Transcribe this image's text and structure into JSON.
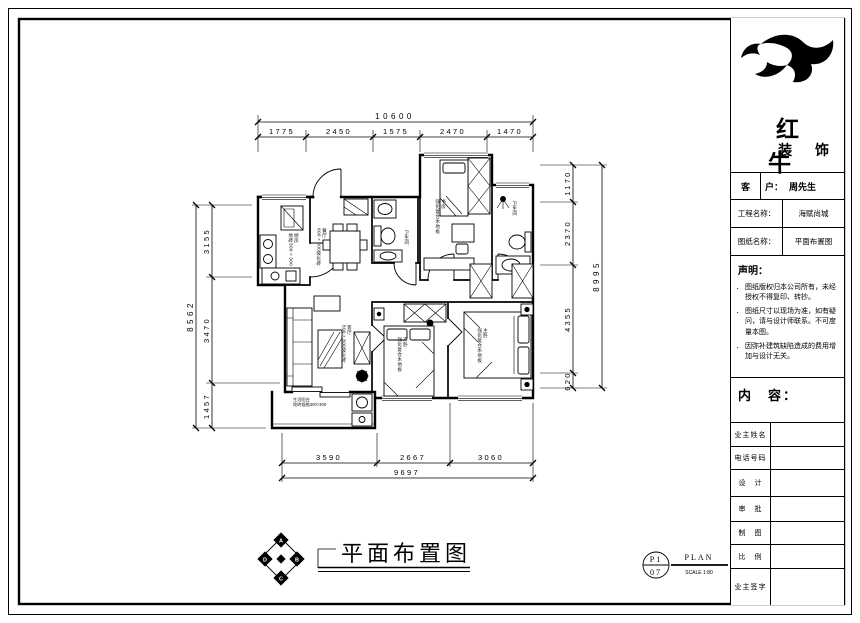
{
  "titleblock": {
    "brand_line1": "红 牛",
    "brand_line2": "装 饰",
    "client_label": "客",
    "client_field": "户：",
    "client_value": "周先生",
    "project_label": "工程名称：",
    "project_value": "海赋尚城",
    "sheet_label": "图纸名称：",
    "sheet_value": "平面布置图",
    "statement_title": "声明：",
    "statement_items": [
      "图纸版权归本公司所有，未经授权不得复印、转抄。",
      "图纸尺寸以现场为准，如有疑问，请与设计师联系。不可度量本图。",
      "因弥补建筑缺陷造成的费用增加与设计无关。"
    ],
    "content_label": "内　容：",
    "footer_rows": [
      {
        "label": "业主姓名",
        "value": ""
      },
      {
        "label": "电话号码",
        "value": ""
      },
      {
        "label": "设　计",
        "value": ""
      },
      {
        "label": "审　批",
        "value": ""
      },
      {
        "label": "制　图",
        "value": ""
      },
      {
        "label": "比　例",
        "value": ""
      },
      {
        "label": "业主签字",
        "value": ""
      }
    ]
  },
  "drawing": {
    "caption": "平面布置图",
    "stamp": {
      "top": "P1",
      "bottom": "07",
      "name": "PLAN",
      "scale": "SCALE 1:80"
    },
    "compass": {
      "north": "A",
      "east": "B",
      "south": "C",
      "west": "D"
    },
    "dims": {
      "top_overall": "10600",
      "top_segments": [
        "1775",
        "2450",
        "1575",
        "2470",
        "1470"
      ],
      "bottom_overall": "9697",
      "bottom_segments": [
        "3590",
        "2667",
        "3060"
      ],
      "left_overall": "8562",
      "left_segments": [
        "3155",
        "3470",
        "1457"
      ],
      "right_overall": "8995",
      "right_segments": [
        "1170",
        "2370",
        "4355",
        "620"
      ]
    },
    "rooms": {
      "kitchen": {
        "name": "厨房",
        "note": "地砖300×300"
      },
      "dining": {
        "name": "餐厅",
        "note": "800×800玻化砖"
      },
      "living": {
        "name": "客厅",
        "note": "800×800玻化砖"
      },
      "bath1": {
        "name": "卫生间",
        "note": ""
      },
      "study": {
        "name": "书房",
        "note": "强化复合木地板"
      },
      "bath2": {
        "name": "卫生间",
        "note": ""
      },
      "bed2": {
        "name": "次卧",
        "note": "强化复合木地板"
      },
      "master": {
        "name": "主卧",
        "note": "强化复合木地板"
      },
      "balcony": {
        "name": "生活阳台",
        "note": "地砖规格300×300"
      }
    }
  }
}
